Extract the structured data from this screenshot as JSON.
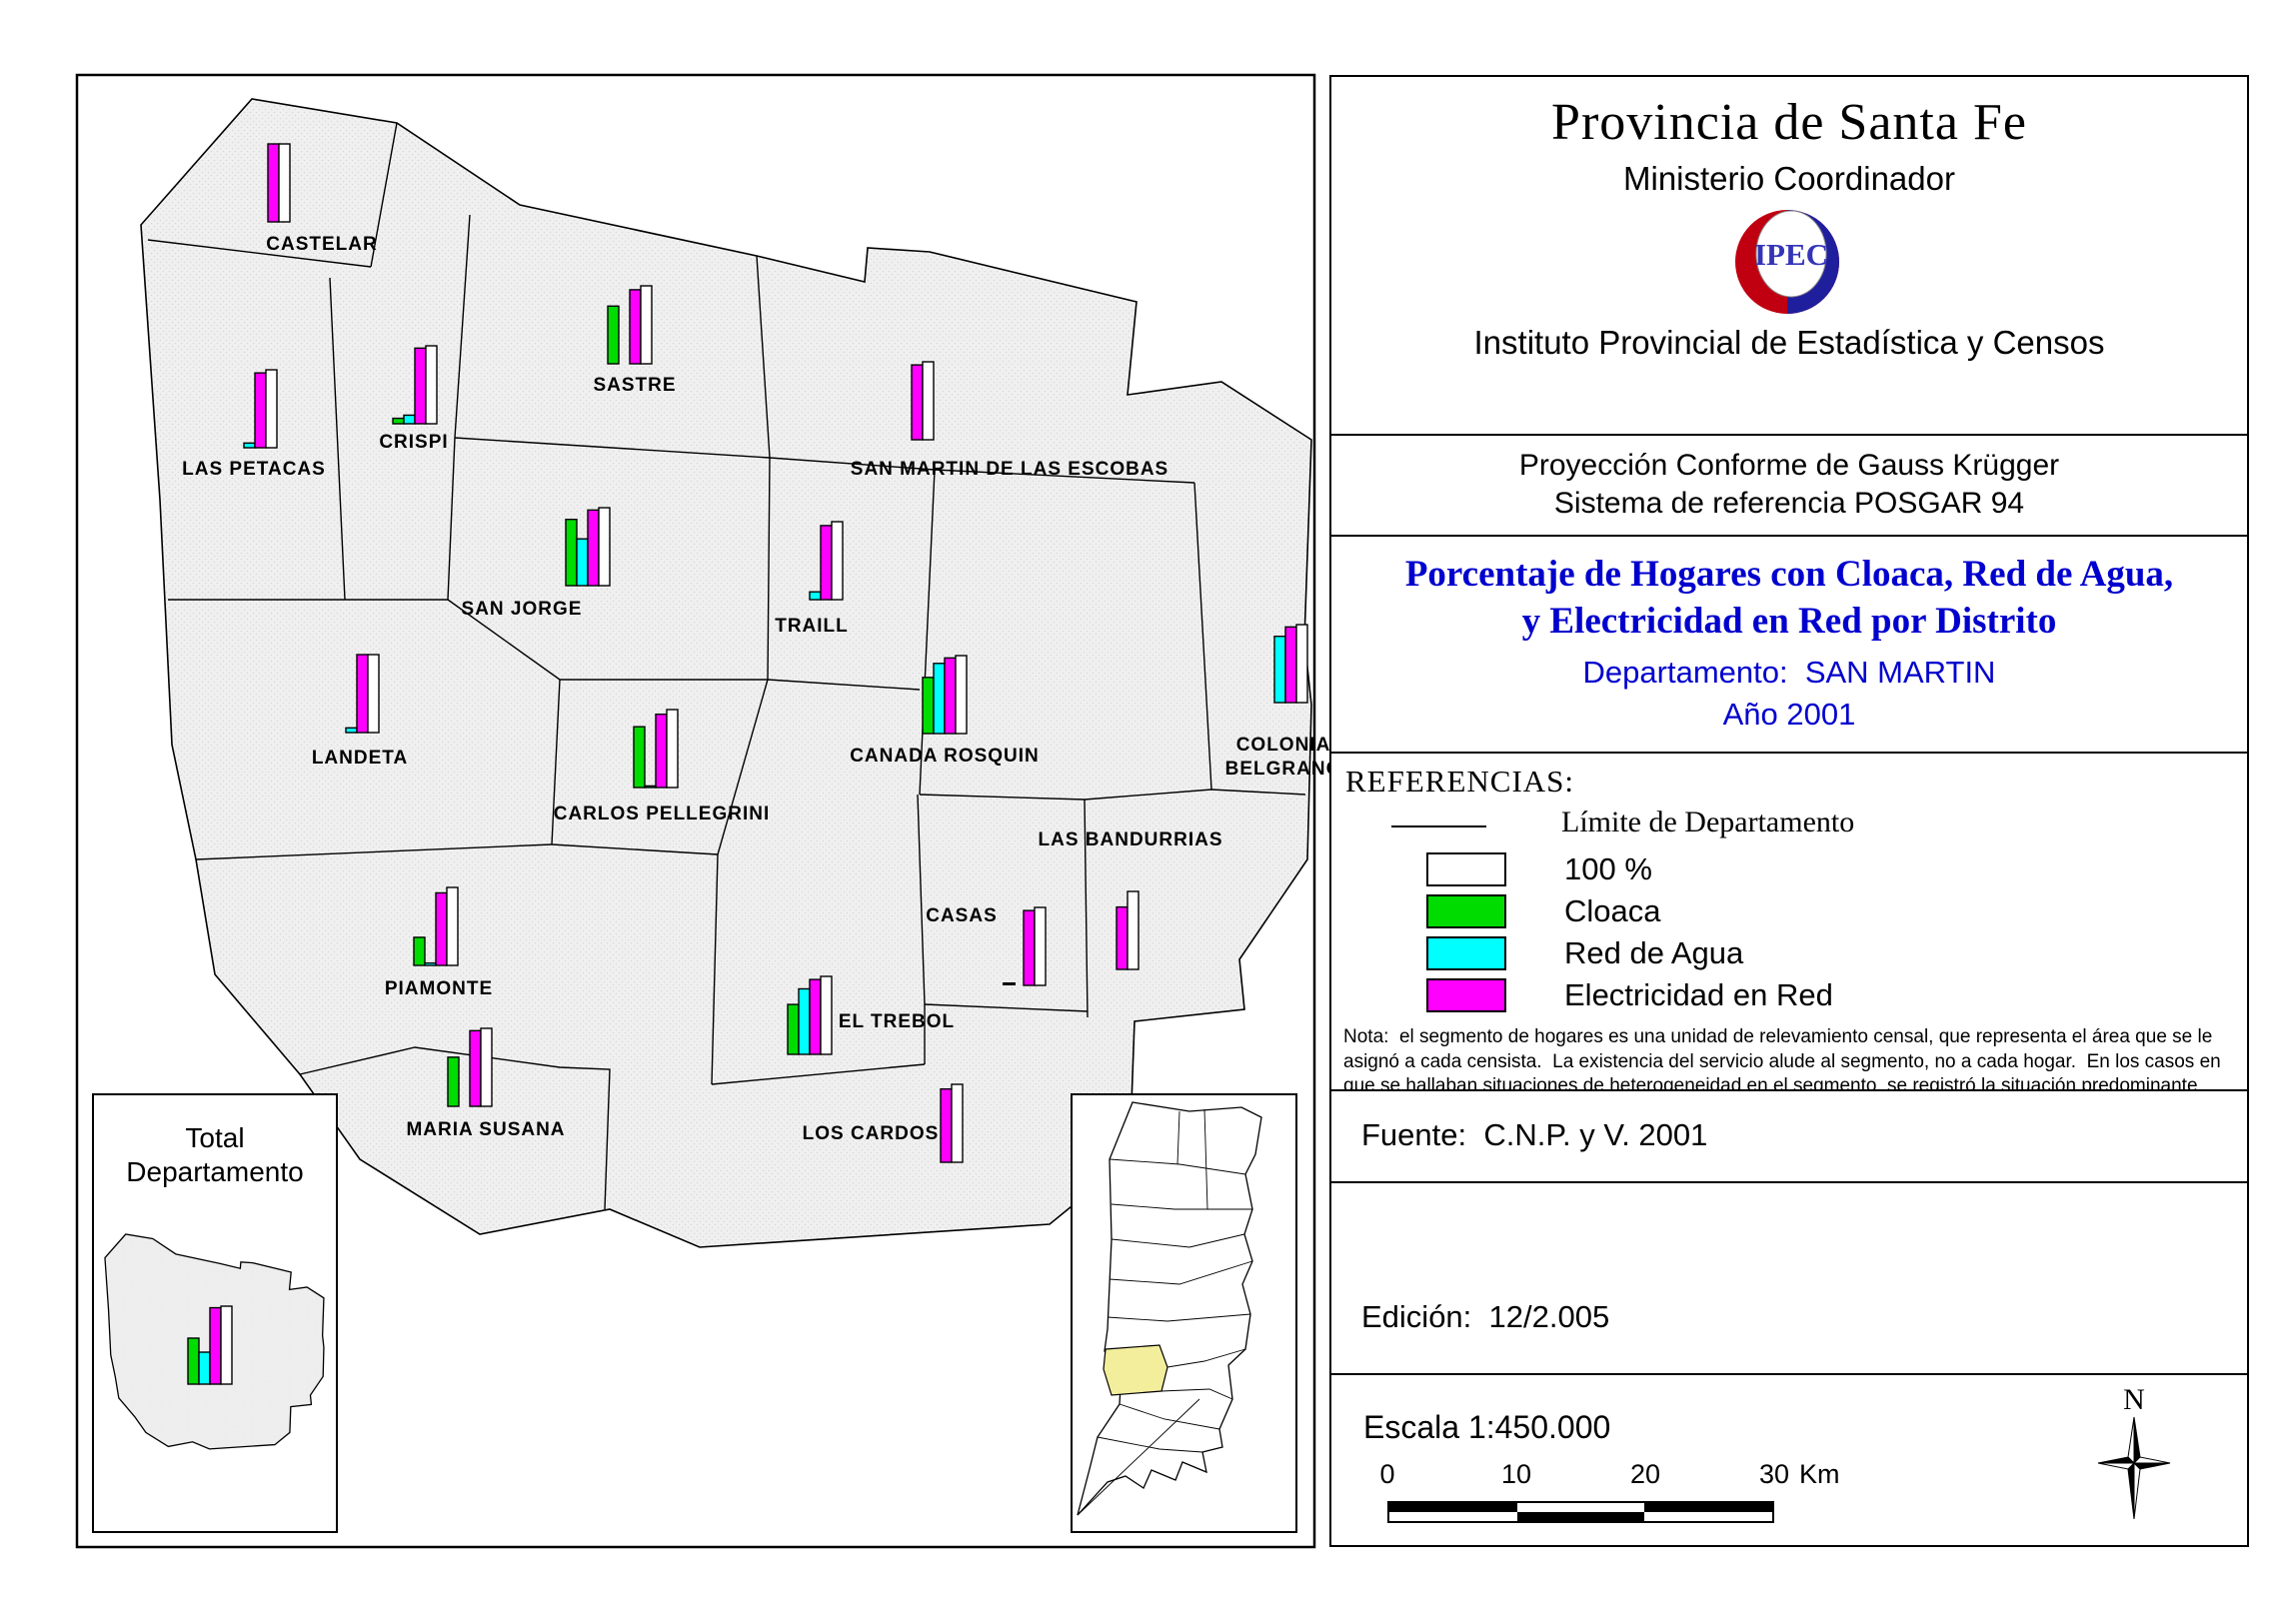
{
  "colors": {
    "cloaca": "#00DC00",
    "red_de_agua": "#00FFFF",
    "electricidad": "#FF00FF",
    "full": "#FFFFFF",
    "map_fill": "#F0F0F0",
    "stipple_dot": "#D9D9D9",
    "title_blue": "#0000CE",
    "logo_red": "#C8randomness0010",
    "highlight_yellow": "#F2EE9C"
  },
  "panel": {
    "header": {
      "title": "Provincia de Santa Fe",
      "subtitle": "Ministerio Coordinador",
      "logo_text": "IPEC",
      "org": "Instituto Provincial de Estadística y Censos"
    },
    "projection": {
      "line1": "Proyección Conforme de Gauss Krügger",
      "line2": "Sistema de referencia POSGAR 94"
    },
    "map_title": {
      "line1": "Porcentaje de Hogares con Cloaca, Red de Agua,",
      "line2": "y Electricidad en Red por Distrito",
      "department": "Departamento:  SAN MARTIN",
      "year": "Año 2001"
    },
    "references": {
      "heading": "REFERENCIAS:",
      "limit_label": "Límite de Departamento",
      "legend": [
        {
          "label": "100 %",
          "color": "#FFFFFF"
        },
        {
          "label": "Cloaca",
          "color": "#00DC00"
        },
        {
          "label": "Red de Agua",
          "color": "#00FFFF"
        },
        {
          "label": "Electricidad en Red",
          "color": "#FF00FF"
        }
      ],
      "note": "Nota:  el segmento de hogares es una unidad de relevamiento censal, que representa el área que se le asignó a cada censista.  La existencia del servicio alude al segmento, no a cada hogar.  En los casos en que se hallaban situaciones de heterogeneidad en el segmento, se registró la situación predominante."
    },
    "fuente": "Fuente:  C.N.P. y V. 2001",
    "edicion": {
      "line1": "Edición:  12/2.005",
      "line2": "Actualización:  07/2.005",
      "line3": "Es propiedad Ley 10.547"
    },
    "escala": {
      "label": "Escala 1:450.000",
      "ticks": [
        "0",
        "10",
        "20",
        "30"
      ],
      "unit": "Km"
    },
    "compass_label": "N"
  },
  "map": {
    "total_inset": {
      "title_line1": "Total",
      "title_line2": "Departamento",
      "cloaca": 59,
      "agua": 41,
      "electricidad": 98,
      "full": 100
    },
    "districts": [
      {
        "id": "castelar",
        "name": "CASTELAR",
        "cloaca": 0,
        "agua": 0,
        "electricidad": 100
      },
      {
        "id": "las-petacas",
        "name": "LAS PETACAS",
        "cloaca": 0,
        "agua": 6,
        "electricidad": 96
      },
      {
        "id": "crispi",
        "name": "CRISPI",
        "cloaca": 7,
        "agua": 11,
        "electricidad": 97
      },
      {
        "id": "sastre",
        "name": "SASTRE",
        "cloaca": 74,
        "agua": 0,
        "electricidad": 95
      },
      {
        "id": "san-martin-de-las-escobas",
        "name": "SAN MARTIN DE LAS ESCOBAS",
        "cloaca": 0,
        "agua": 0,
        "electricidad": 96
      },
      {
        "id": "san-jorge",
        "name": "SAN JORGE",
        "cloaca": 85,
        "agua": 60,
        "electricidad": 97
      },
      {
        "id": "traill",
        "name": "TRAILL",
        "cloaca": 0,
        "agua": 10,
        "electricidad": 95
      },
      {
        "id": "colonia-belgrano",
        "name": "COLONIA BELGRANO",
        "lines": [
          "COLONIA",
          "BELGRANO"
        ],
        "cloaca": 0,
        "agua": 85,
        "electricidad": 97
      },
      {
        "id": "canada-rosquin",
        "name": "CANADA ROSQUIN",
        "cloaca": 72,
        "agua": 90,
        "electricidad": 97
      },
      {
        "id": "landeta",
        "name": "LANDETA",
        "cloaca": 0,
        "agua": 6,
        "electricidad": 100
      },
      {
        "id": "carlos-pellegrini",
        "name": "CARLOS PELLEGRINI",
        "cloaca": 78,
        "agua": 2,
        "electricidad": 94
      },
      {
        "id": "las-bandurrias",
        "name": "LAS BANDURRIAS",
        "cloaca": 0,
        "agua": 0,
        "electricidad": 80
      },
      {
        "id": "casas",
        "name": "CASAS",
        "cloaca": 0,
        "agua": 0,
        "electricidad": 96,
        "zero_dash": true
      },
      {
        "id": "piamonte",
        "name": "PIAMONTE",
        "cloaca": 36,
        "agua": 3,
        "electricidad": 93
      },
      {
        "id": "el-trebol",
        "name": "EL TREBOL",
        "cloaca": 64,
        "agua": 84,
        "electricidad": 96
      },
      {
        "id": "maria-susana",
        "name": "MARIA SUSANA",
        "cloaca": 63,
        "agua": 0,
        "electricidad": 97
      },
      {
        "id": "los-cardos",
        "name": "LOS CARDOS",
        "cloaca": 0,
        "agua": 0,
        "electricidad": 94
      }
    ]
  },
  "chart_data": {
    "type": "bar",
    "title": "Porcentaje de Hogares con Cloaca, Red de Agua, y Electricidad en Red por Distrito",
    "subtitle": "Departamento: SAN MARTIN — Año 2001",
    "ylabel": "%",
    "ylim": [
      0,
      100
    ],
    "legend_position": "right-panel",
    "categories": [
      "CASTELAR",
      "LAS PETACAS",
      "CRISPI",
      "SASTRE",
      "SAN MARTIN DE LAS ESCOBAS",
      "SAN JORGE",
      "TRAILL",
      "COLONIA BELGRANO",
      "CANADA ROSQUIN",
      "LANDETA",
      "CARLOS PELLEGRINI",
      "LAS BANDURRIAS",
      "CASAS",
      "PIAMONTE",
      "EL TREBOL",
      "MARIA SUSANA",
      "LOS CARDOS",
      "Total Departamento"
    ],
    "series": [
      {
        "name": "Cloaca",
        "values": [
          0,
          0,
          7,
          74,
          0,
          85,
          0,
          0,
          72,
          0,
          78,
          0,
          0,
          36,
          64,
          63,
          0,
          59
        ]
      },
      {
        "name": "Red de Agua",
        "values": [
          0,
          6,
          11,
          0,
          0,
          60,
          10,
          85,
          90,
          6,
          2,
          0,
          0,
          3,
          84,
          0,
          0,
          41
        ]
      },
      {
        "name": "Electricidad en Red",
        "values": [
          100,
          96,
          97,
          95,
          96,
          97,
          95,
          97,
          97,
          100,
          94,
          80,
          96,
          93,
          96,
          97,
          94,
          98
        ]
      },
      {
        "name": "100 %",
        "values": [
          100,
          100,
          100,
          100,
          100,
          100,
          100,
          100,
          100,
          100,
          100,
          100,
          100,
          100,
          100,
          100,
          100,
          100
        ]
      }
    ]
  }
}
